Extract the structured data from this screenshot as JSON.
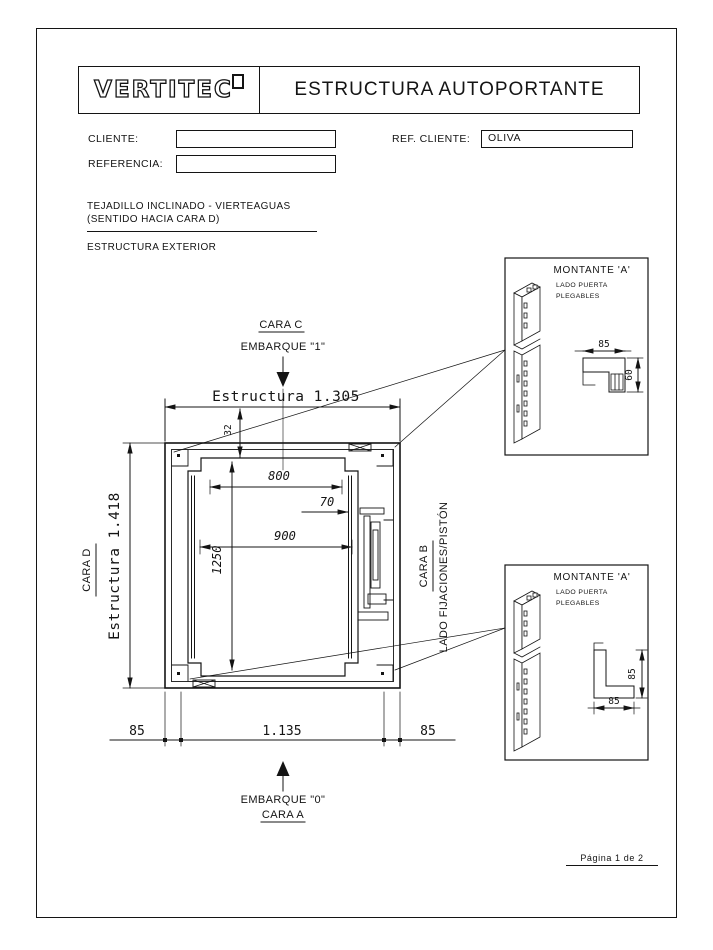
{
  "colors": {
    "ink": "#141414",
    "paper": "#ffffff"
  },
  "header": {
    "logo": "VERTITEC",
    "title": "ESTRUCTURA AUTOPORTANTE"
  },
  "form": {
    "cliente_label": "CLIENTE:",
    "cliente_value": "",
    "referencia_label": "REFERENCIA:",
    "referencia_value": "",
    "ref_cliente_label": "REF. CLIENTE:",
    "ref_cliente_value": "OLIVA"
  },
  "notes": {
    "roof_line1": "TEJADILLO INCLINADO - VIERTEAGUAS",
    "roof_line2": "(SENTIDO HACIA CARA D)",
    "section_title": "ESTRUCTURA EXTERIOR"
  },
  "plan": {
    "cara_c_label": "CARA C",
    "embarque_top_label": "EMBARQUE \"1\"",
    "dim_estructura_width": "Estructura 1.305",
    "dim_roof_offset": "32",
    "dim_door_clear": "800",
    "dim_piston_offset": "70",
    "dim_cabin_width": "900",
    "dim_cabin_depth": "1250",
    "cara_d_label": "CARA D",
    "dim_estructura_depth": "Estructura 1.418",
    "cara_b_label": "CARA B",
    "lado_fijaciones_label": "LADO FIJACIONES/PISTÓN",
    "dim_post_left": "85",
    "dim_clear_width": "1.135",
    "dim_post_right": "85",
    "embarque_bottom_label": "EMBARQUE \"0\"",
    "cara_a_label": "CARA A"
  },
  "detail_top": {
    "title": "MONTANTE 'A'",
    "subtitle1": "LADO PUERTA",
    "subtitle2": "PLEGABLES",
    "dim_width": "85",
    "dim_height": "60"
  },
  "detail_bottom": {
    "title": "MONTANTE 'A'",
    "subtitle1": "LADO PUERTA",
    "subtitle2": "PLEGABLES",
    "dim_width": "85",
    "dim_height": "85"
  },
  "footer": {
    "page_label": "Página 1 de 2"
  }
}
